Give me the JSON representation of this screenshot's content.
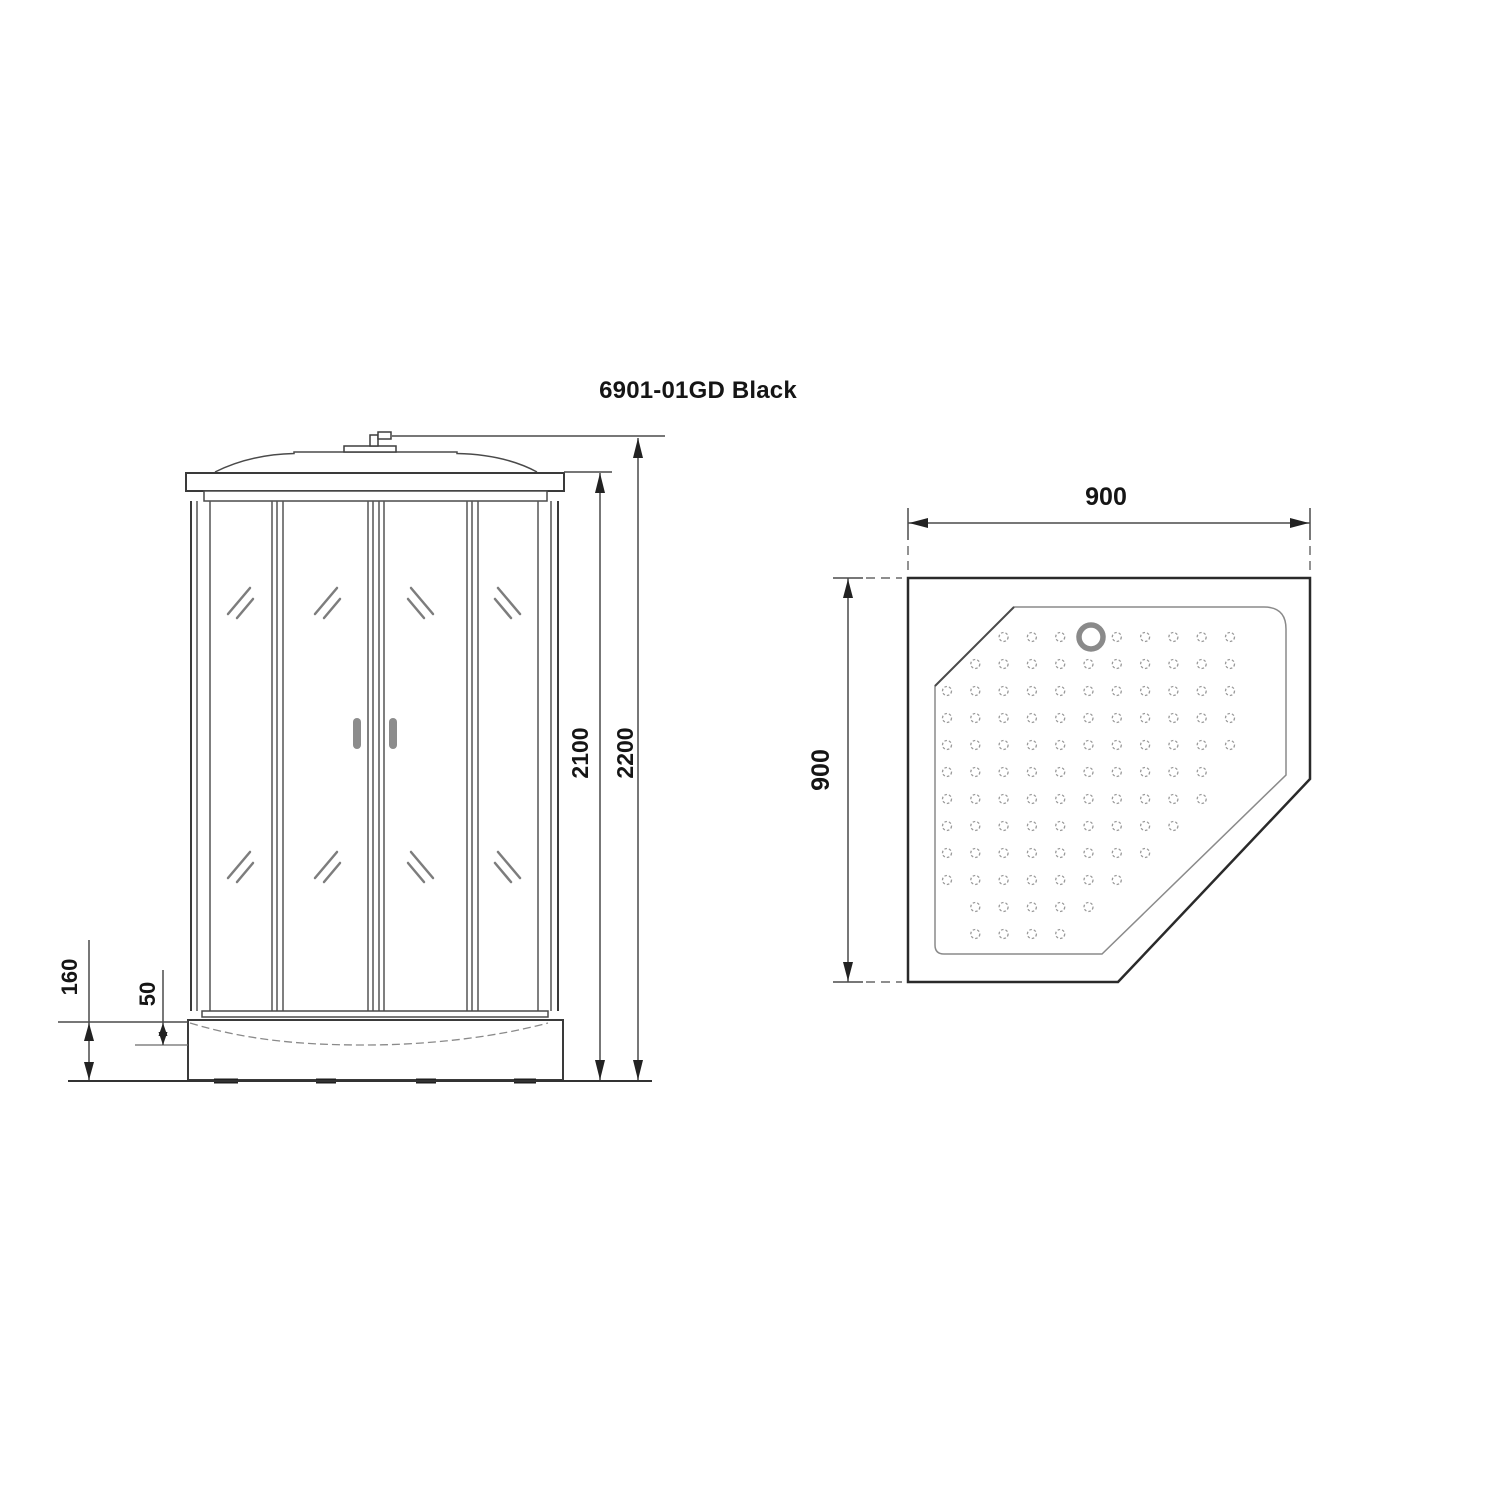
{
  "title": {
    "text": "6901-01GD Black"
  },
  "front_view": {
    "dims": {
      "total_height": "2200",
      "cabin_height": "2100",
      "base_height": "160",
      "tray_lip_height": "50"
    }
  },
  "plan_view": {
    "dims": {
      "width": "900",
      "depth": "900"
    }
  }
}
